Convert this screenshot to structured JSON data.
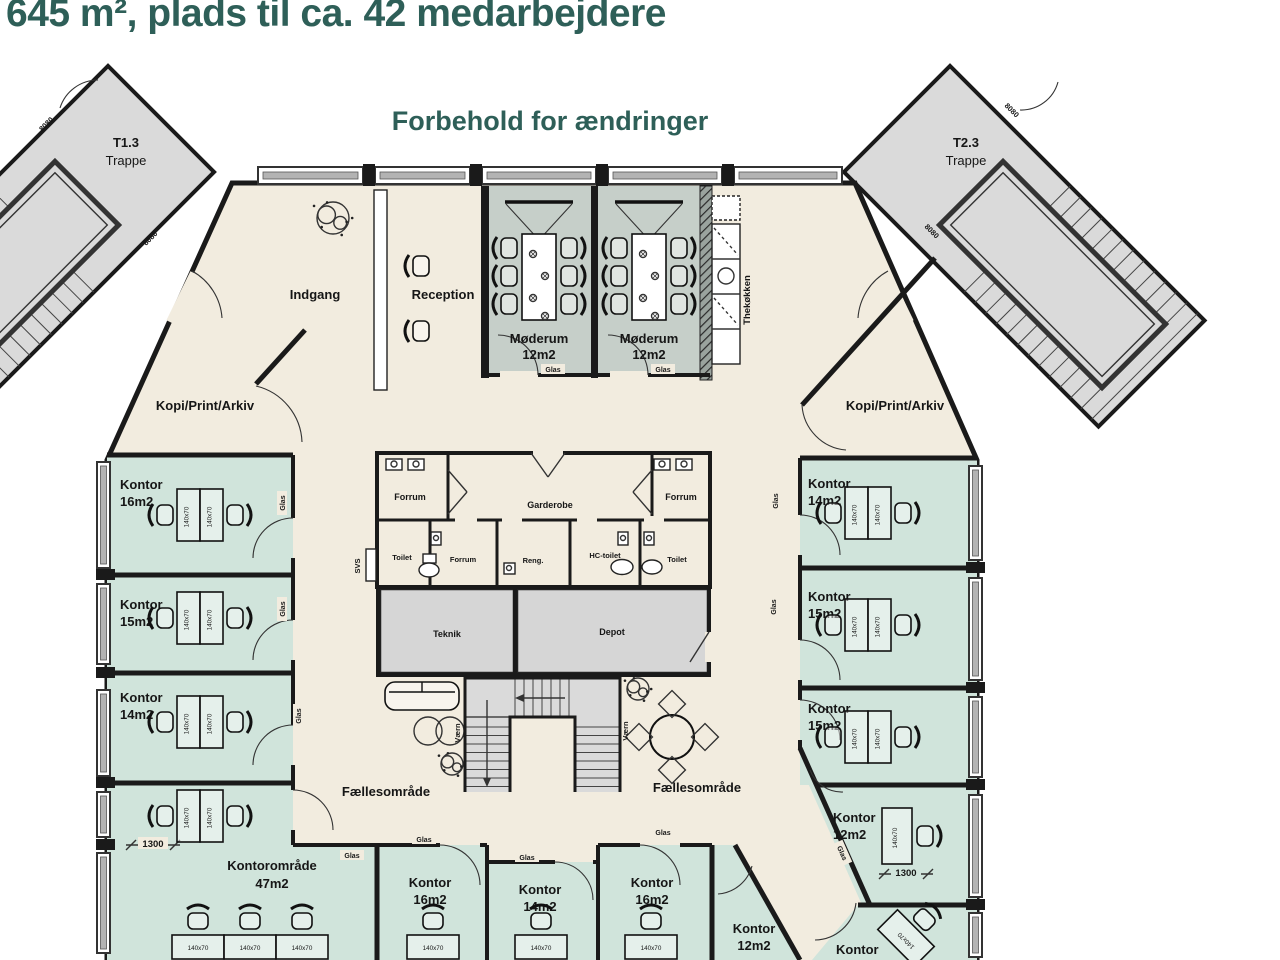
{
  "header": {
    "title": "645 m², plads til ca. 42 medarbejdere"
  },
  "plan": {
    "note": "Forbehold for ændringer",
    "stairwells": {
      "left_id": "T1.3",
      "right_id": "T2.3",
      "label": "Trappe",
      "door_code": "8080"
    },
    "areas": {
      "indgang": "Indgang",
      "reception": "Reception",
      "faellesomraade": "Fællesområde",
      "kopi": "Kopi/Print/Arkiv"
    },
    "rooms": {
      "moederum": {
        "name": "Møderum",
        "size": "12m2"
      },
      "thekoekken": "Thekøkken"
    },
    "core": {
      "forrum": "Forrum",
      "garderobe": "Garderobe",
      "toilet": "Toilet",
      "reng": "Reng.",
      "hc_toilet": "HC-toilet",
      "teknik": "Teknik",
      "depot": "Depot",
      "svs": "SVS"
    },
    "offices": {
      "kontor": "Kontor",
      "left_sizes": [
        "16m2",
        "15m2",
        "14m2"
      ],
      "right_sizes": [
        "14m2",
        "15m2",
        "15m2",
        "12m2"
      ],
      "bottom_sizes": [
        "16m2",
        "14m2",
        "16m2",
        "12m2"
      ],
      "open_office": {
        "name": "Kontorområde",
        "size": "47m2"
      }
    },
    "labels": {
      "glas": "Glas",
      "vaern": "Værn",
      "desk": "140x70",
      "dim": "1300"
    }
  },
  "colors": {
    "accent_text": "#2e5f58",
    "floor": "#f2ecdf",
    "office": "#d0e4db",
    "meeting": "#c6cfc9",
    "stair": "#dadada",
    "service": "#d6d6d6",
    "wall": "#1a1a1a"
  }
}
